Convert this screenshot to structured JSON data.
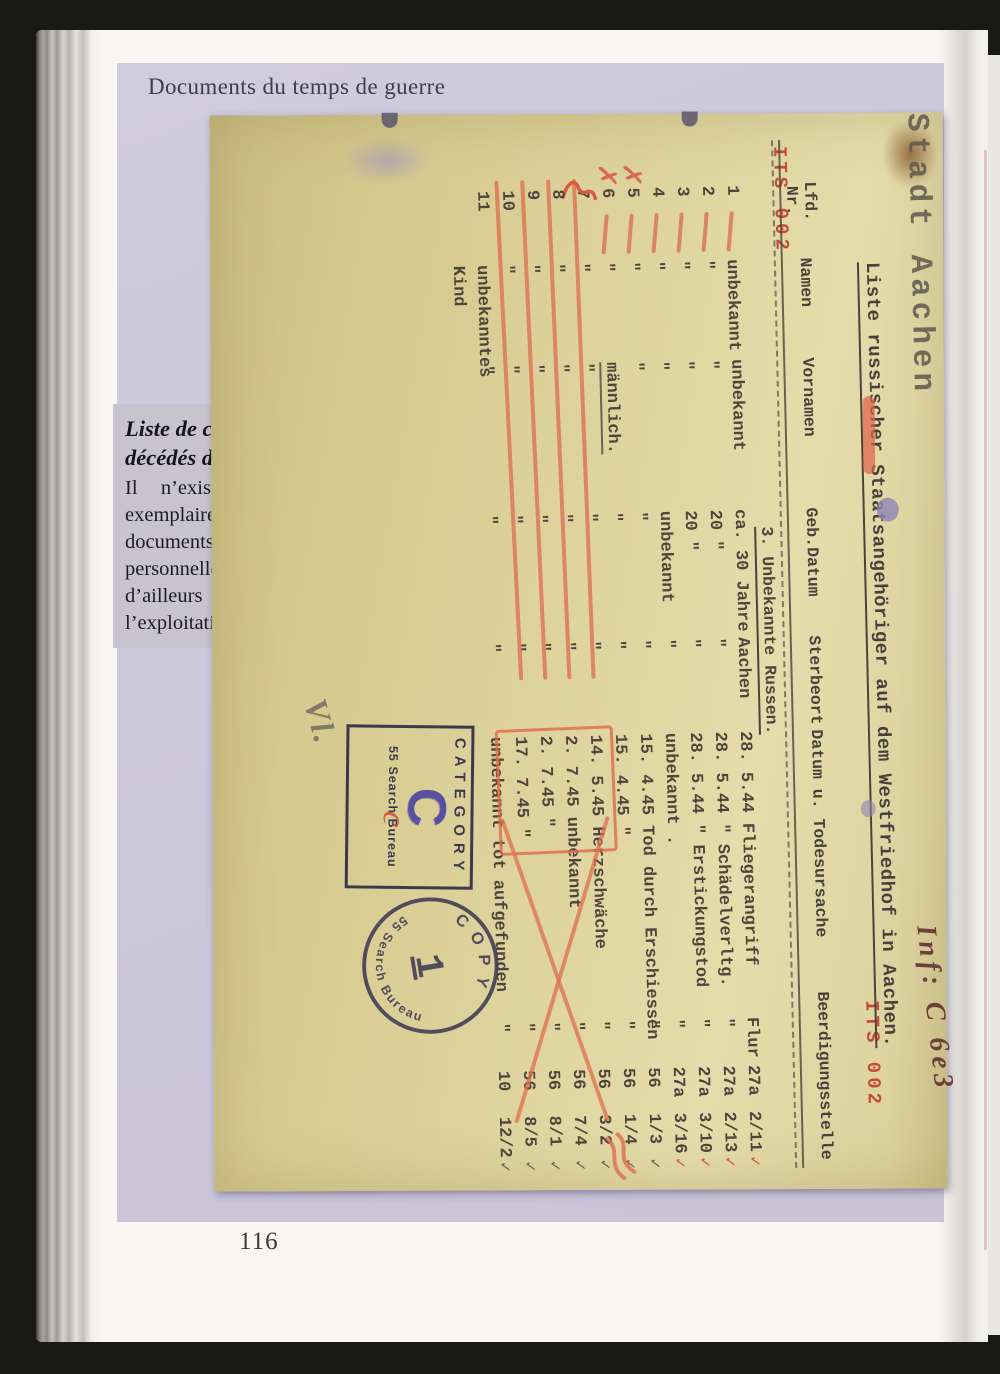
{
  "page": {
    "running_head": "Documents du temps de guerre",
    "folio": "116"
  },
  "caption": {
    "title_line1": "Liste de citoyens russes",
    "title_line2": "décédés d’identité inconnue",
    "body": "Il n’existe que quelques rares exemplaires de ce genre de documents. Faute de données personnelles concrètes, ceux-ci sont d’ailleurs peu utiles pour l’exploitation mandataire."
  },
  "document": {
    "handwritten_top": "Stadt Aachen",
    "its_stamp": "ITS 002",
    "title": "Liste russischer Staatsangehöriger auf dem Westfriedhof in Aachen.",
    "red_annotation": "Inf: C 6e3",
    "section_heading": "3. Unbekannte Russen.",
    "headers": {
      "lfd": "Lfd.",
      "nr": "Nr.",
      "namen": "Namen",
      "vornamen": "Vornamen",
      "geb": "Geb.Datum",
      "sterbeort": "Sterbeort",
      "datum": "Datum u. Todesursache",
      "beerdigung": "Beerdigungsstelle"
    },
    "rows": [
      {
        "nr": "1",
        "namen": "unbekannt",
        "vornamen": "unbekannt",
        "geb": "ca. 30 Jahre",
        "ort": "Aachen",
        "datum": "28. 5.44 Fliegerangriff",
        "flur": "Flur",
        "fnr": "27a",
        "grab": "2/11",
        "check": "red",
        "red_dash": true
      },
      {
        "nr": "2",
        "namen": "\"",
        "vornamen": "\"",
        "geb": "20 \"",
        "ort": "\"",
        "datum": "28. 5.44 \" Schädelverltg.",
        "flur": "\"",
        "fnr": "27a",
        "grab": "2/13",
        "check": "red",
        "red_dash": true
      },
      {
        "nr": "3",
        "namen": "\"",
        "vornamen": "\"",
        "geb": "20 \"",
        "ort": "\"",
        "datum": "28. 5.44 \" Erstickungstod",
        "flur": "\"",
        "fnr": "27a",
        "grab": "3/10",
        "check": "red",
        "red_dash": true
      },
      {
        "nr": "4",
        "namen": "\"",
        "vornamen": "\"",
        "geb": "unbekannt",
        "ort": "\"",
        "datum": "unbekannt .",
        "flur": "\"",
        "fnr": "27a",
        "grab": "3/16",
        "check": "red",
        "red_dash": true
      },
      {
        "nr": "5",
        "namen": "\"",
        "vornamen": "\"",
        "geb": "\"",
        "ort": "\"",
        "datum": "15. 4.45 Tod durch Erschiessen",
        "flur": "\"",
        "fnr": "56",
        "grab": "1/3",
        "check": "grey",
        "red_dash": true,
        "red_x": true
      },
      {
        "nr": "6",
        "namen": "\"",
        "vornamen": "männlich.",
        "geb": "\"",
        "ort": "\"",
        "datum": "15. 4.45 \"",
        "flur": "\"",
        "fnr": "56",
        "grab": "1/4",
        "check": "grey",
        "red_dash": true,
        "red_x": true,
        "vn_underline": true
      },
      {
        "nr": "7",
        "namen": "\"",
        "vornamen": "\"",
        "geb": "\"",
        "ort": "\"",
        "datum": "14. 5.45 Herzschwäche",
        "flur": "\"",
        "fnr": "56",
        "grab": "3/2",
        "check": "grey",
        "strike": true,
        "squiggle": true
      },
      {
        "nr": "8",
        "namen": "\"",
        "vornamen": "\"",
        "geb": "\"",
        "ort": "\"",
        "datum": "2. 7.45 unbekannt",
        "flur": "\"",
        "fnr": "56",
        "grab": "7/4",
        "check": "grey",
        "strike": true
      },
      {
        "nr": "9",
        "namen": "\"",
        "vornamen": "\"",
        "geb": "\"",
        "ort": "\"",
        "datum": "2. 7.45 \"",
        "flur": "\"",
        "fnr": "56",
        "grab": "8/1",
        "check": "grey",
        "strike": true
      },
      {
        "nr": "10",
        "namen": "\"",
        "vornamen": "\"",
        "geb": "\"",
        "ort": "\"",
        "datum": "17. 7.45 \"",
        "flur": "\"",
        "fnr": "56",
        "grab": "8/5",
        "check": "grey",
        "strike": true
      },
      {
        "nr": "11",
        "namen": "unbekanntes Kind",
        "vornamen": "\"",
        "geb": "\"",
        "ort": "\"",
        "datum": "unbekannt tot aufgefunden",
        "flur": "\"",
        "fnr": "10",
        "grab": "12/2",
        "check": "grey"
      }
    ],
    "checkmark": "✓",
    "stamps": {
      "category": {
        "word": "CATEGORY",
        "letter": "C",
        "bureau": "55 Search Bureau",
        "red_letter": "c"
      },
      "copy": {
        "word": "COPY",
        "number": "1",
        "bureau": "55 Search Bureau"
      }
    },
    "pencil_initials": "Vl."
  }
}
